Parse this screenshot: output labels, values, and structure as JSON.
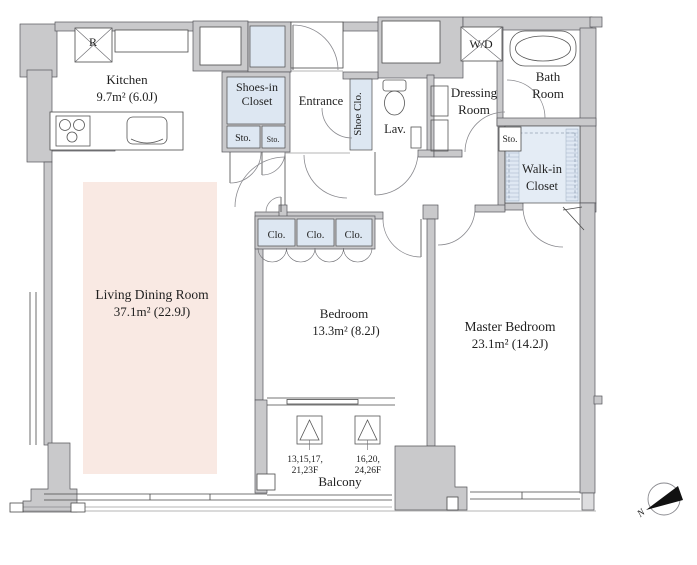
{
  "page": {
    "title": "Apartment floor plan"
  },
  "rooms": {
    "kitchen": {
      "name": "Kitchen",
      "area": "9.7m² (6.0J)"
    },
    "living_dining": {
      "name": "Living Dining Room",
      "area": "37.1m² (22.9J)"
    },
    "bedroom": {
      "name": "Bedroom",
      "area": "13.3m² (8.2J)"
    },
    "master_bedroom": {
      "name": "Master Bedroom",
      "area": "23.1m² (14.2J)"
    },
    "entrance": {
      "name": "Entrance"
    },
    "lavatory": {
      "name": "Lav."
    },
    "bath": {
      "line1": "Bath",
      "line2": "Room"
    },
    "dressing": {
      "line1": "Dressing",
      "line2": "Room"
    },
    "shoes_in_closet": {
      "line1": "Shoes-in",
      "line2": "Closet"
    },
    "walk_in_closet": {
      "line1": "Walk-in",
      "line2": "Closet"
    },
    "shoe_closet": {
      "name": "Shoe Clo."
    },
    "washer_dryer": {
      "name": "W/D"
    },
    "balcony": {
      "name": "Balcony"
    }
  },
  "markers": {
    "refrigerator": "R",
    "storage": "Sto.",
    "closet": "Clo.",
    "evac_hatch_floors_1": {
      "line1": "13,15,17,",
      "line2": "21,23F"
    },
    "evac_hatch_floors_2": {
      "line1": "16,20,",
      "line2": "24,26F"
    },
    "compass_north": "N"
  },
  "colors": {
    "wall": "#c9c9cb",
    "closet_fill": "#dde7f2",
    "living_fill": "#f9e9e3",
    "line": "#4a4a4a"
  }
}
